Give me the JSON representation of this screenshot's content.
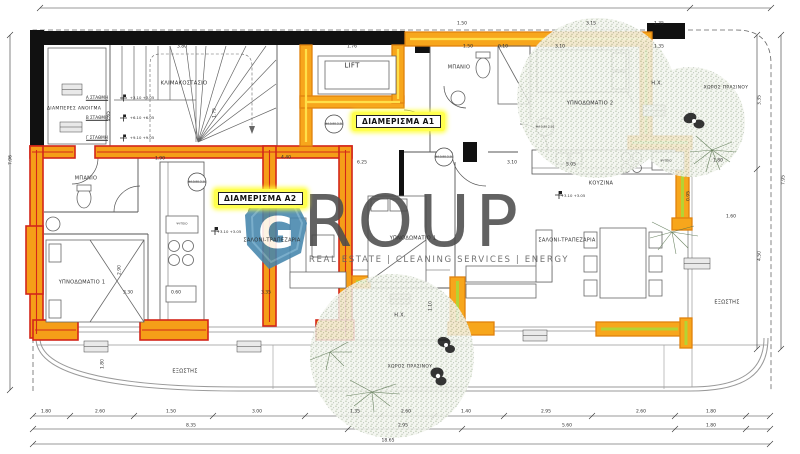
{
  "page": {
    "type": "architectural-floor-plan",
    "total_width_label": "18.65",
    "total_height_left_label": "7.96",
    "total_height_right_label": "7.95"
  },
  "brand": {
    "name": "GROUP",
    "tagline": "REAL ESTATE | CLEANING SERVICES | ENERGY",
    "logo_letter": "G",
    "logo_color": "#4586ad",
    "text_color": "#4d4d4d"
  },
  "apartments": [
    {
      "id": "A1",
      "label": "ΔΙΑΜΕΡΙΣΜΑ Α1",
      "highlight_color": "#f7a61c"
    },
    {
      "id": "A2",
      "label": "ΔΙΑΜΕΡΙΣΜΑ Α2",
      "highlight_color": "#d3261a"
    }
  ],
  "colors": {
    "red_wall": "#d3261a",
    "orange_wall": "#f5a01d",
    "yellow_core": "#ffd84d",
    "green_core": "#b5d333",
    "black_wall": "#111111",
    "tree_green": "#728c60",
    "tag_yellow": "#ffff4f",
    "logo_blue": "#4586ad"
  },
  "labels": [
    {
      "t": "ΚΛΙΜΑΚΟΣΤΑΣΙΟ",
      "x": 184,
      "y": 84,
      "s": 5.2,
      "c": "room",
      "n": "room-label-staircase"
    },
    {
      "t": "ΔΙΑΜΠΕΡΕΣ ΑΝΟΙΓΜΑ",
      "x": 74,
      "y": 110,
      "s": 4.6,
      "c": "room",
      "n": "room-label-through-opening"
    },
    {
      "t": "LIFT",
      "x": 352,
      "y": 66,
      "s": 7,
      "c": "room",
      "n": "room-label-lift"
    },
    {
      "t": "ΜΠΑΝΙΟ",
      "x": 459,
      "y": 68,
      "s": 5,
      "c": "room",
      "n": "room-label-bathroom-a1"
    },
    {
      "t": "ΥΠΝΟΔΩΜΑΤΙΟ 2",
      "x": 590,
      "y": 104,
      "s": 5,
      "c": "room",
      "n": "room-label-bedroom2-a1"
    },
    {
      "t": "Η.Χ.",
      "x": 657,
      "y": 84,
      "s": 5,
      "c": "room",
      "n": "room-label-hx-top"
    },
    {
      "t": "ΧΩΡΟΣ ΠΡΑΣΙΝΟΥ",
      "x": 726,
      "y": 89,
      "s": 4.4,
      "c": "green",
      "n": "green-area-label-top"
    },
    {
      "t": "ΜΠΑΝΙΟ",
      "x": 86,
      "y": 179,
      "s": 5,
      "c": "room",
      "n": "room-label-bathroom-a2"
    },
    {
      "t": "ΥΠΝΟΔΩΜΑΤΙΟ 1",
      "x": 82,
      "y": 283,
      "s": 5,
      "c": "room",
      "n": "room-label-bedroom1-a2"
    },
    {
      "t": "ΣΑΛΟΝΙ-ΤΡΑΠΕΖΑΡΙΑ",
      "x": 272,
      "y": 241,
      "s": 5,
      "c": "room",
      "n": "room-label-living-a2"
    },
    {
      "t": "ΥΠΝΟΔΩΜΑΤΙΟ 1",
      "x": 413,
      "y": 239,
      "s": 5,
      "c": "room",
      "n": "room-label-bedroom1-a1"
    },
    {
      "t": "ΚΟΥΖΙΝΑ",
      "x": 601,
      "y": 184,
      "s": 5,
      "c": "room",
      "n": "room-label-kitchen"
    },
    {
      "t": "ΣΑΛΟΝΙ-ΤΡΑΠΕΖΑΡΙΑ",
      "x": 567,
      "y": 241,
      "s": 5,
      "c": "room",
      "n": "room-label-living-a1"
    },
    {
      "t": "Η.Χ.",
      "x": 400,
      "y": 316,
      "s": 5,
      "c": "room",
      "n": "room-label-hx-bottom"
    },
    {
      "t": "ΕΞΩΣΤΗΣ",
      "x": 185,
      "y": 372,
      "s": 5,
      "c": "room",
      "n": "room-label-balcony-left"
    },
    {
      "t": "ΕΞΩΣΤΗΣ",
      "x": 727,
      "y": 303,
      "s": 5,
      "c": "room",
      "n": "room-label-balcony-right"
    },
    {
      "t": "ΧΩΡΟΣ ΠΡΑΣΙΝΟΥ",
      "x": 410,
      "y": 368,
      "s": 4.4,
      "c": "green",
      "n": "green-area-label-bottom"
    },
    {
      "t": "ΨΥΓΕΙΟ",
      "x": 182,
      "y": 224,
      "s": 3,
      "c": "tiny",
      "n": "fridge-label-a2"
    },
    {
      "t": "ΨΥΓΕΙΟ",
      "x": 666,
      "y": 161,
      "s": 3,
      "c": "tiny",
      "n": "fridge-label-a1"
    },
    {
      "t": "Α ΣΤΑΘΜΗ",
      "x": 97,
      "y": 98,
      "s": 4.2,
      "c": "stair",
      "n": "stair-level-a"
    },
    {
      "t": "Β ΣΤΑΘΜΗ",
      "x": 97,
      "y": 118,
      "s": 4.2,
      "c": "stair",
      "n": "stair-level-b"
    },
    {
      "t": "Γ ΣΤΑΘΜΗ",
      "x": 97,
      "y": 138,
      "s": 4.2,
      "c": "stair",
      "n": "stair-level-c"
    },
    {
      "t": "+3.10\n+3.05",
      "x": 142,
      "y": 98,
      "s": 3.8,
      "c": "elev",
      "n": "stair-level-a-elevation"
    },
    {
      "t": "+6.10\n+6.05",
      "x": 142,
      "y": 118,
      "s": 3.8,
      "c": "elev",
      "n": "stair-level-b-elevation"
    },
    {
      "t": "+9.10\n+9.05",
      "x": 142,
      "y": 138,
      "s": 3.8,
      "c": "elev",
      "n": "stair-level-c-elevation"
    },
    {
      "t": "+3.10\n+3.05",
      "x": 229,
      "y": 232,
      "s": 3.8,
      "c": "elev",
      "n": "floor-elevation-a2"
    },
    {
      "t": "+3.10\n+3.05",
      "x": 573,
      "y": 196,
      "s": 3.8,
      "c": "elev",
      "n": "floor-elevation-a1"
    },
    {
      "t": "Φ4\n0.90 2.10",
      "x": 334,
      "y": 124,
      "s": 2.8,
      "c": "tag",
      "n": "door-tag"
    },
    {
      "t": "Φ4\n0.90 2.10",
      "x": 444,
      "y": 157,
      "s": 2.8,
      "c": "tag",
      "n": "door-tag"
    },
    {
      "t": "Φ4\n0.90 2.10",
      "x": 545,
      "y": 127,
      "s": 2.8,
      "c": "tag",
      "n": "door-tag"
    },
    {
      "t": "Φ4\n0.90 2.10",
      "x": 197,
      "y": 182,
      "s": 2.8,
      "c": "tag",
      "n": "door-tag"
    },
    {
      "t": "1.50",
      "x": 462,
      "y": 25
    },
    {
      "t": "3.15",
      "x": 591,
      "y": 25
    },
    {
      "t": "1.35",
      "x": 659,
      "y": 25
    },
    {
      "t": "3.80",
      "x": 182,
      "y": 48
    },
    {
      "t": "1.76",
      "x": 352,
      "y": 48
    },
    {
      "t": "1.50",
      "x": 468,
      "y": 48
    },
    {
      "t": "0.10",
      "x": 503,
      "y": 48
    },
    {
      "t": "3.10",
      "x": 560,
      "y": 48
    },
    {
      "t": "1.35",
      "x": 659,
      "y": 48
    },
    {
      "t": "1.90",
      "x": 160,
      "y": 160
    },
    {
      "t": "4.40",
      "x": 286,
      "y": 159
    },
    {
      "t": "6.25",
      "x": 362,
      "y": 164
    },
    {
      "t": "3.10",
      "x": 512,
      "y": 164
    },
    {
      "t": "5.05",
      "x": 571,
      "y": 166
    },
    {
      "t": "1.80",
      "x": 718,
      "y": 162
    },
    {
      "t": "1.60",
      "x": 731,
      "y": 218
    },
    {
      "t": "3.30",
      "x": 128,
      "y": 294
    },
    {
      "t": "0.60",
      "x": 176,
      "y": 294
    },
    {
      "t": "3.35",
      "x": 266,
      "y": 294
    },
    {
      "t": "2.65",
      "x": 110,
      "y": 116,
      "r": -90
    },
    {
      "t": "1.75",
      "x": 216,
      "y": 113,
      "r": -90
    },
    {
      "t": "2.90",
      "x": 121,
      "y": 270,
      "r": -90
    },
    {
      "t": "1.80",
      "x": 104,
      "y": 364,
      "r": -90
    },
    {
      "t": "1.10",
      "x": 432,
      "y": 306,
      "r": -90
    },
    {
      "t": "0.95",
      "x": 690,
      "y": 196,
      "r": -90
    },
    {
      "t": "7.96",
      "x": 12,
      "y": 160,
      "r": -90
    },
    {
      "t": "3.35",
      "x": 761,
      "y": 100,
      "r": -90
    },
    {
      "t": "4.50",
      "x": 761,
      "y": 256,
      "r": -90
    },
    {
      "t": "7.95",
      "x": 785,
      "y": 180,
      "r": -90
    },
    {
      "t": "1.80",
      "x": 46,
      "y": 413
    },
    {
      "t": "2.60",
      "x": 100,
      "y": 413
    },
    {
      "t": "1.50",
      "x": 171,
      "y": 413
    },
    {
      "t": "3.00",
      "x": 257,
      "y": 413
    },
    {
      "t": "1.35",
      "x": 355,
      "y": 413
    },
    {
      "t": "2.60",
      "x": 406,
      "y": 413
    },
    {
      "t": "1.40",
      "x": 466,
      "y": 413
    },
    {
      "t": "2.95",
      "x": 546,
      "y": 413
    },
    {
      "t": "2.60",
      "x": 641,
      "y": 413
    },
    {
      "t": "1.80",
      "x": 711,
      "y": 413
    },
    {
      "t": "8.35",
      "x": 191,
      "y": 427
    },
    {
      "t": "2.95",
      "x": 403,
      "y": 427
    },
    {
      "t": "5.60",
      "x": 567,
      "y": 427
    },
    {
      "t": "1.80",
      "x": 711,
      "y": 427
    },
    {
      "t": "18.65",
      "x": 388,
      "y": 442
    }
  ]
}
